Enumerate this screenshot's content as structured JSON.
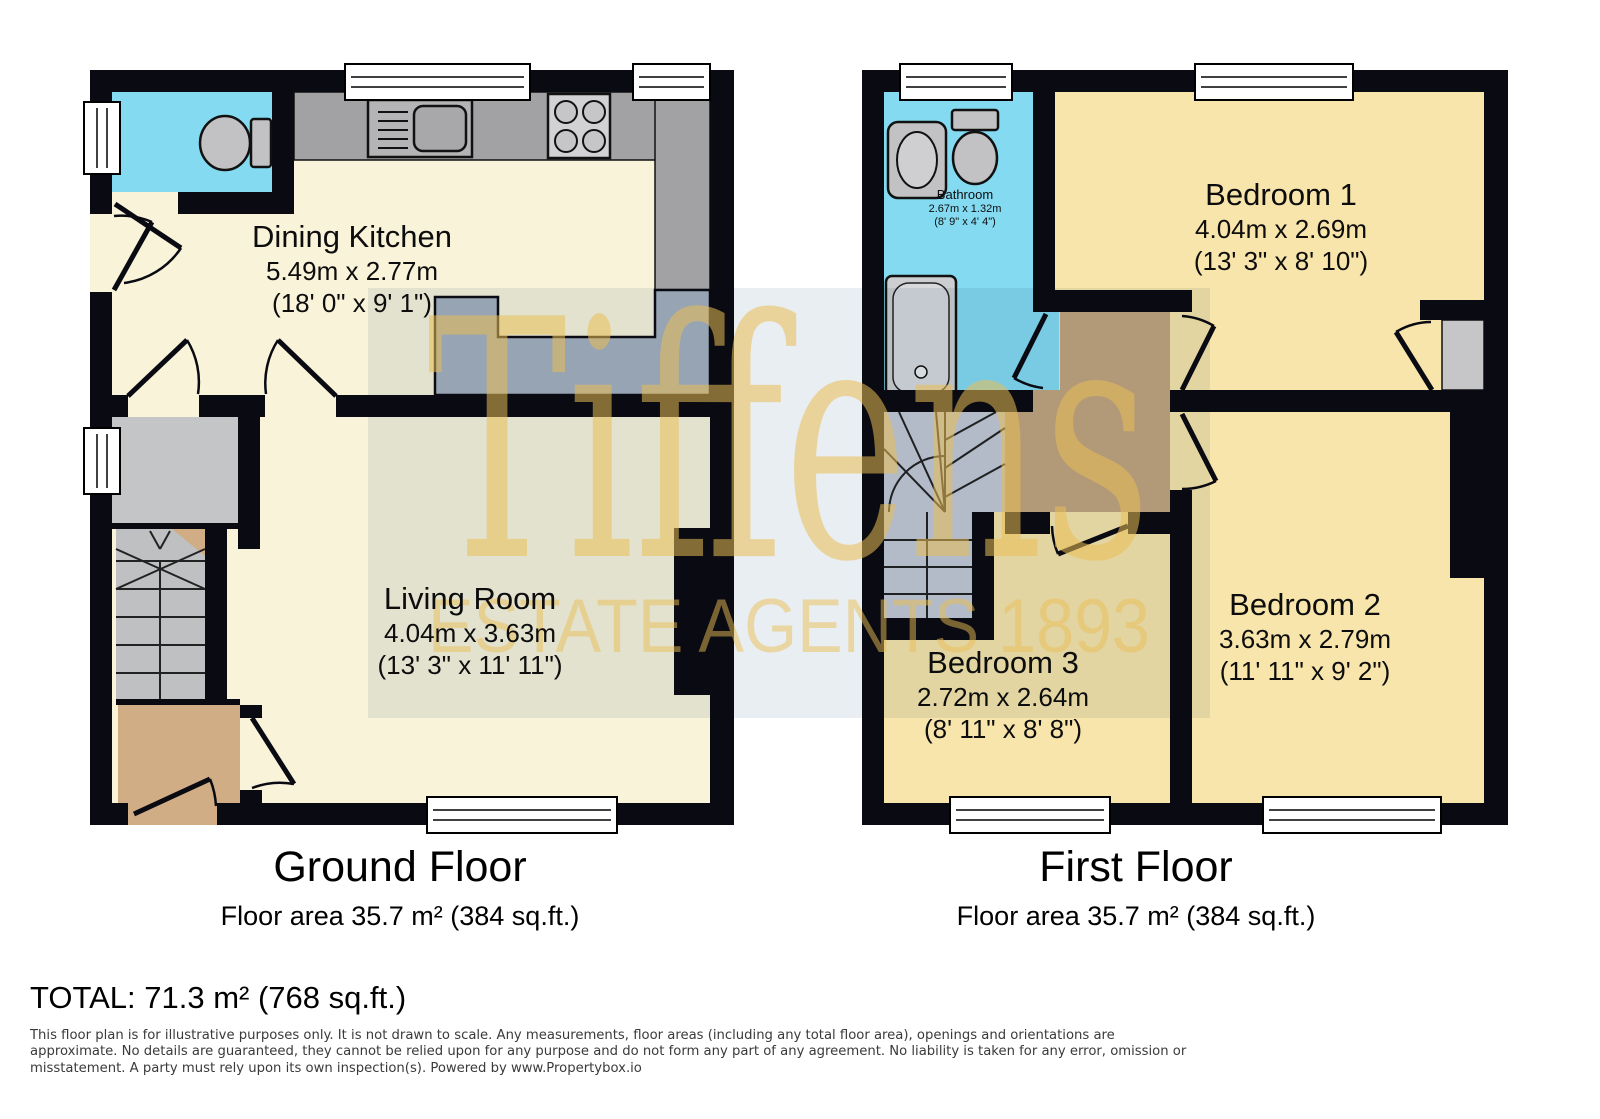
{
  "watermark": {
    "brand": "Tiffens",
    "tagline": "ESTATE AGENTS 1893",
    "gold_color": "#e9bd54"
  },
  "floors": [
    {
      "name": "Ground Floor",
      "area": "Floor area 35.7 m² (384 sq.ft.)"
    },
    {
      "name": "First Floor",
      "area": "Floor area 35.7 m² (384 sq.ft.)"
    }
  ],
  "rooms": [
    {
      "name": "Dining Kitchen",
      "metric": "5.49m x 2.77m",
      "imperial": "(18' 0\" x 9' 1\")"
    },
    {
      "name": "Living Room",
      "metric": "4.04m x 3.63m",
      "imperial": "(13' 3\" x 11' 11\")"
    },
    {
      "name": "Bathroom",
      "metric": "2.67m x 1.32m",
      "imperial": "(8' 9\" x 4' 4\")"
    },
    {
      "name": "Bedroom 1",
      "metric": "4.04m x 2.69m",
      "imperial": "(13' 3\" x 8' 10\")"
    },
    {
      "name": "Bedroom 2",
      "metric": "3.63m x 2.79m",
      "imperial": "(11' 11\" x 9' 2\")"
    },
    {
      "name": "Bedroom 3",
      "metric": "2.72m x 2.64m",
      "imperial": "(8' 11\" x 8' 8\")"
    }
  ],
  "total": "TOTAL: 71.3 m² (768 sq.ft.)",
  "disclaimer": {
    "line1": "This floor plan is for illustrative purposes only. It is not drawn to scale. Any measurements, floor areas (including any total floor area), openings and orientations are",
    "line2": "approximate. No details are guaranteed, they cannot be relied upon for any purpose and do not form any part of any agreement. No liability is taken for any error, omission or",
    "line3": "misstatement. A party must rely upon its own inspection(s). Powered by www.Propertybox.io"
  },
  "colors": {
    "wall": "#0a0a12",
    "floor_cream": "#f9f3da",
    "floor_bedroom": "#f8e5ab",
    "wet_room_cyan": "#84daf1",
    "counter_gray": "#a2a2a4",
    "hall_tan": "#d1ad85",
    "watermark_gold": "#e9bd54"
  }
}
